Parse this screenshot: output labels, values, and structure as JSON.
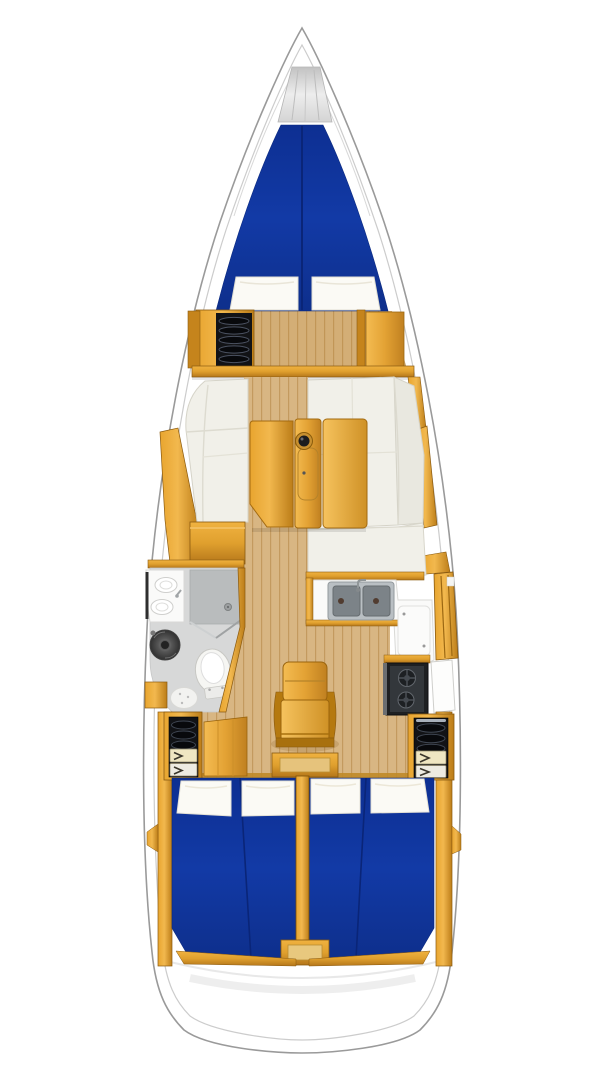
{
  "document": {
    "type": "sailboat interior floor plan",
    "view": "top-down deck plan",
    "orientation": "bow up, stern down"
  },
  "colors": {
    "hull_white": "#ffffff",
    "outline_gray": "#9a9a9a",
    "gunwale_gray": "#cccccc",
    "berth_blue": "#11359f",
    "berth_seam": "#0a2578",
    "cushion_white": "#f1f0e9",
    "cushion_back": "#e9e8e0",
    "pillow_white": "#fbfaf5",
    "wood_amber": "#e8a52f",
    "wood_deep": "#bc7d18",
    "sole_tan": "#d8b683",
    "sole_line": "#c39a5f",
    "head_floor": "#d7d8d8",
    "shower_gray": "#b9bcbd",
    "counter_white": "#fafaf9",
    "sink_gray": "#7c8388",
    "steel_gray": "#b9bfc3",
    "appliance_black": "#1e2022",
    "locker_black": "#121316",
    "drawer_cream": "#efe6c2",
    "anchor_silver": "#d9d9d9"
  },
  "areas": {
    "bow": {
      "name": "bow",
      "features": {
        "anchor_locker": "silver locker at stem"
      }
    },
    "forward_cabin": {
      "name": "forward cabin",
      "berth": "double V-berth, blue mattress with center seam",
      "pillow_count": 2,
      "port_feature": "open shelf locker with 5 dark slatted shelves",
      "starboard_feature": "wardrobe door panel",
      "bulkhead": "full-width wood bulkhead aft of cabin"
    },
    "saloon": {
      "name": "saloon",
      "port_side": "chaise settee with storage bench aft",
      "starboard_side": "L-shaped settee with aft corner bench",
      "table": "drop-leaf wood table, center column with bottle holder hole",
      "sole": "wood plank sole strip on centerline"
    },
    "head": {
      "name": "head / shower",
      "fixtures": [
        "vanity counter with twin oval basins",
        "round dark washbasin",
        "shower floor with drain",
        "marine toilet",
        "oval bath mat"
      ]
    },
    "galley": {
      "name": "L-shaped galley",
      "sink_basin_count": 2,
      "stove_burner_count": 2,
      "fixtures": [
        "double stainless sink",
        "top-loading fridge lid",
        "two-burner gimbaled stove",
        "hull-side shelf unit",
        "white locker door"
      ]
    },
    "companionway": {
      "name": "companionway steps",
      "steps": "wood seat-style steps with bottom step box"
    },
    "aft_cabin_port": {
      "name": "aft cabin port",
      "berth": "double berth, blue mattress with seam",
      "pillow_count": 2,
      "entry_locker": "locker with 3 slatted shelves and 2 cream drawers with arrow pulls",
      "door": "open wood door panel"
    },
    "aft_cabin_starboard": {
      "name": "aft cabin starboard",
      "berth": "double berth, blue mattress with seam",
      "pillow_count": 2,
      "entry_locker": "locker with 3 slatted shelves and 2 cream drawers with arrow pulls"
    },
    "stern": {
      "name": "stern / transom",
      "features": {
        "center_box": "engine access box between berths"
      }
    }
  }
}
